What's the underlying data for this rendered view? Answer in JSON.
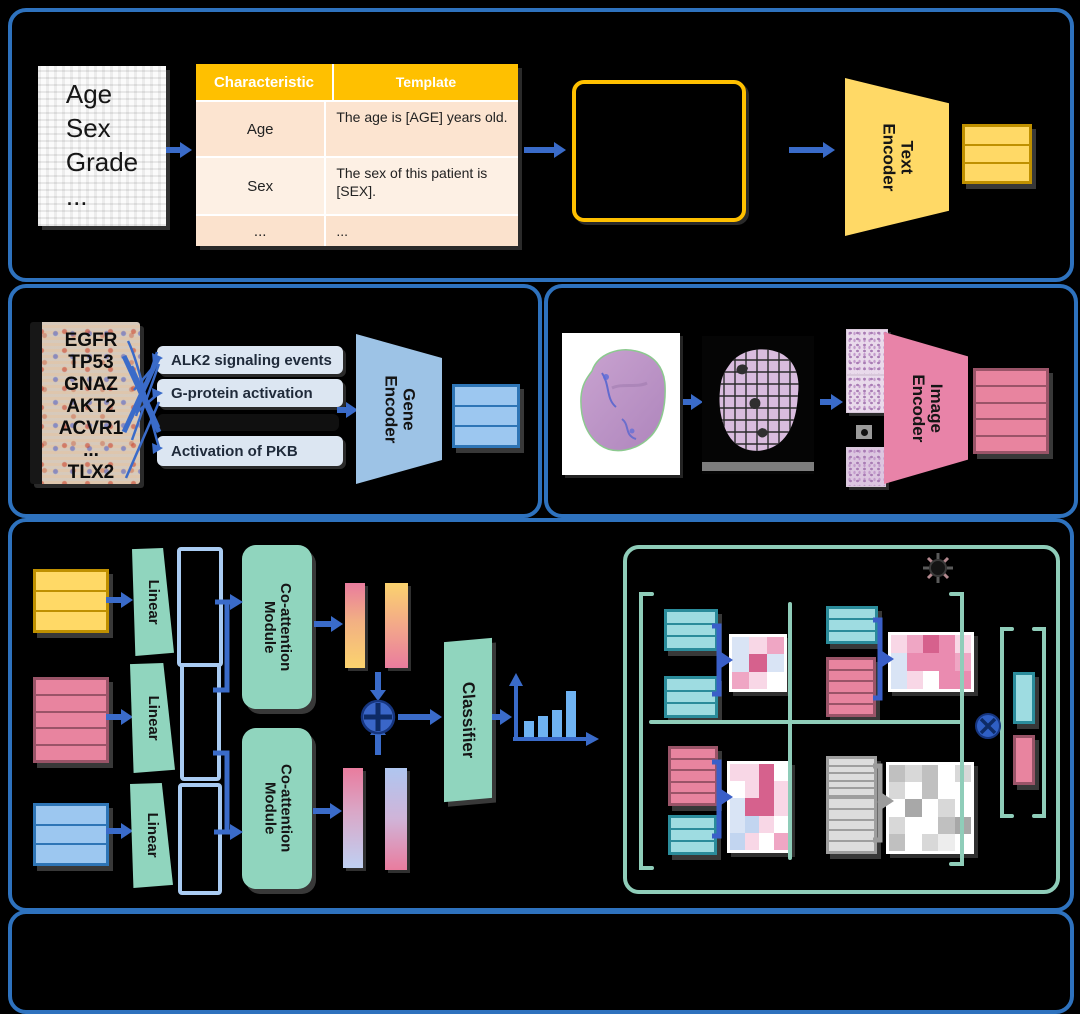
{
  "colors": {
    "panel_border": "#2E72BE",
    "arrow": "#3A6BC9",
    "teal_outline": "#8FCDB9",
    "module_fill": "#90D5BE",
    "text_encoder_fill": "#FFD966",
    "gene_encoder_fill": "#9DC3E6",
    "image_encoder_fill": "#E883A8",
    "chart_bar": "#6FB3F2"
  },
  "block_rows": {
    "three": 3,
    "five": 5,
    "one": 1
  },
  "panel_a": {
    "document_lines": [
      "Age",
      "Sex",
      "Grade",
      "..."
    ],
    "table": {
      "headers": [
        "Characteristic",
        "Template"
      ],
      "rows": [
        [
          "Age",
          "The age is [AGE] years old."
        ],
        [
          "Sex",
          "The sex of this patient is [SEX]."
        ],
        [
          "...",
          "..."
        ]
      ]
    },
    "encoder_label": "Text\nEncoder"
  },
  "panel_b": {
    "genes": [
      "EGFR",
      "TP53",
      "GNAZ",
      "AKT2",
      "ACVR1",
      "...",
      "TLX2"
    ],
    "pathways": [
      "ALK2 signaling events",
      "G-protein activation",
      "Activation of PKB"
    ],
    "encoder_label": "Gene\nEncoder"
  },
  "panel_c": {
    "encoder_label": "Image\nEncoder"
  },
  "panel_d": {
    "linear_label": "Linear",
    "coattention_label": "Co-attention\nModule",
    "classifier_label": "Classifier",
    "output_chart": {
      "type": "bar",
      "bars": [
        17,
        22,
        28,
        47
      ]
    },
    "heatmap_palette": {
      "w": "#FFFFFF",
      "p1": "#F8D7E6",
      "p2": "#EFA6C4",
      "p3": "#D6618D",
      "p4": "#EA8BB0",
      "b1": "#D9E4F5",
      "b2": "#C2D5F0",
      "g1": "#C0C0C0",
      "g2": "#D8D8D8",
      "g3": "#A8A8A8",
      "g4": "#EDEDED"
    },
    "heatmaps": {
      "q1": [
        [
          "b1",
          "p1",
          "p2"
        ],
        [
          "b1",
          "p3",
          "b1"
        ],
        [
          "p2",
          "p1",
          "w"
        ]
      ],
      "q2": [
        [
          "p1",
          "p2",
          "p3",
          "p4",
          "p1"
        ],
        [
          "b1",
          "p4",
          "p4",
          "p4",
          "p2"
        ],
        [
          "b1",
          "p1",
          "w",
          "p4",
          "p4"
        ]
      ],
      "q3": [
        [
          "p1",
          "p1",
          "p3",
          "w"
        ],
        [
          "w",
          "p1",
          "p3",
          "p1"
        ],
        [
          "b1",
          "p3",
          "p3",
          "p1"
        ],
        [
          "b1",
          "b2",
          "p1",
          "w"
        ],
        [
          "b2",
          "p1",
          "w",
          "p2"
        ]
      ],
      "q4": [
        [
          "g1",
          "g2",
          "g1",
          "w",
          "g2"
        ],
        [
          "g2",
          "w",
          "g1",
          "w",
          "w"
        ],
        [
          "w",
          "g3",
          "w",
          "g2",
          "w"
        ],
        [
          "g2",
          "w",
          "w",
          "g1",
          "g3"
        ],
        [
          "g1",
          "w",
          "g2",
          "g4",
          "w"
        ]
      ]
    }
  }
}
